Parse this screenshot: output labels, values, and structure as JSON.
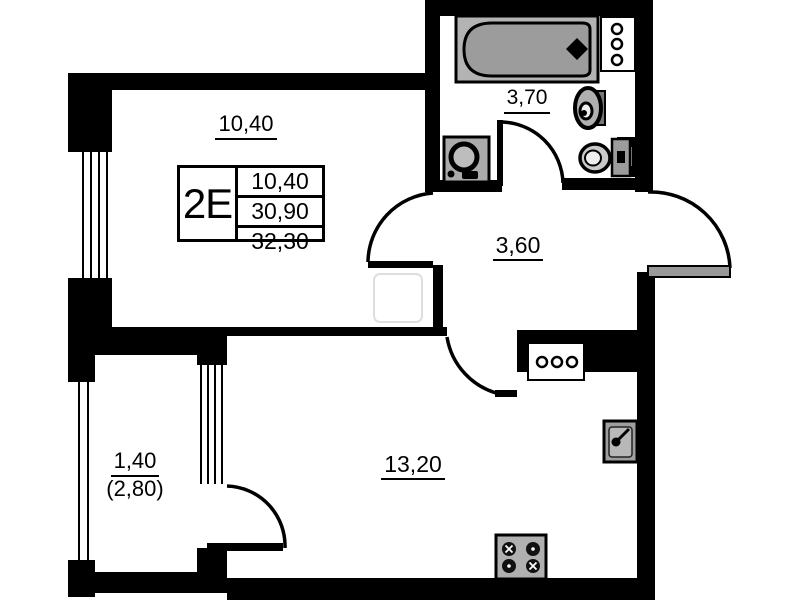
{
  "plan": {
    "legend": {
      "unit": "2E",
      "values": [
        "10,40",
        "30,90",
        "32,30"
      ]
    },
    "labels": {
      "room": "10,40",
      "bathroom": "3,70",
      "hallway": "3,60",
      "living": "13,20",
      "balcony": "1,40",
      "balcony_secondary": "(2,80)"
    },
    "colors": {
      "wall": "#000000",
      "background": "#ffffff",
      "fixture_fill": "#a9a9a9",
      "tub_fill": "#9c9c9c",
      "ghost": "#dedede"
    }
  }
}
